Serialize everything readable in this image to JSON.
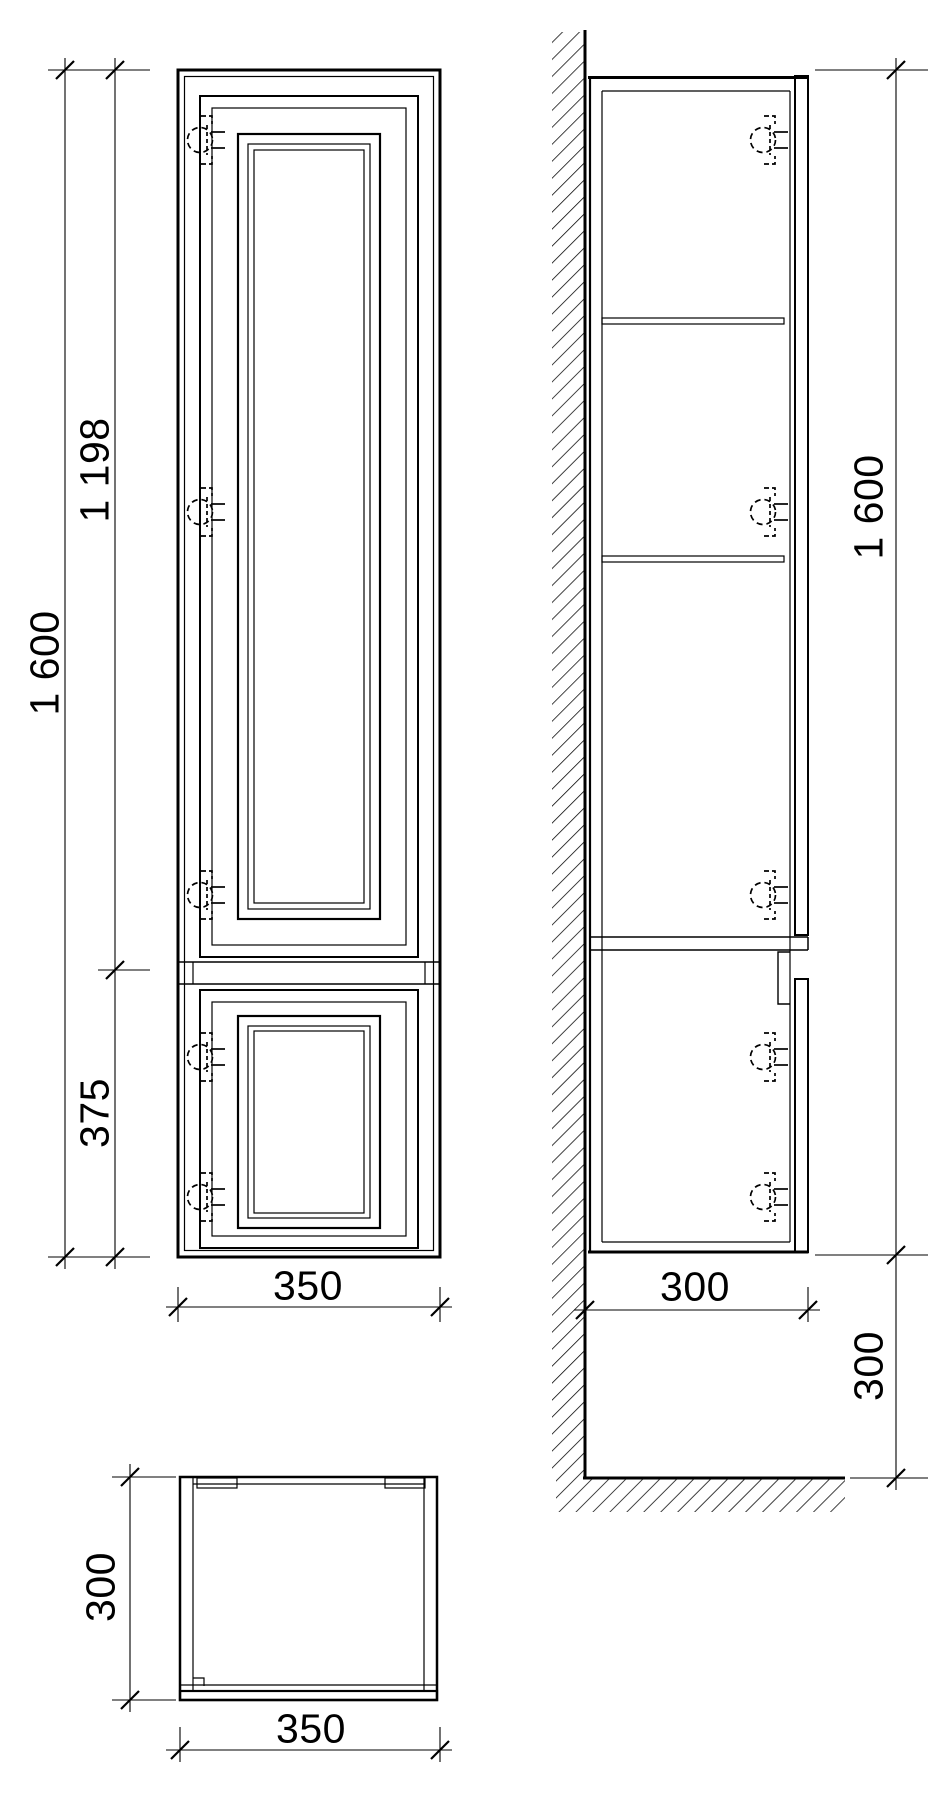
{
  "colors": {
    "line": "#000000",
    "background": "#ffffff"
  },
  "front_view": {
    "height_total": "1 600",
    "door_upper_height": "1 198",
    "door_lower_height": "375",
    "width": "350"
  },
  "side_view": {
    "height_total": "1 600",
    "depth": "300",
    "floor_clearance": "300"
  },
  "top_view": {
    "depth": "300",
    "width": "350"
  }
}
